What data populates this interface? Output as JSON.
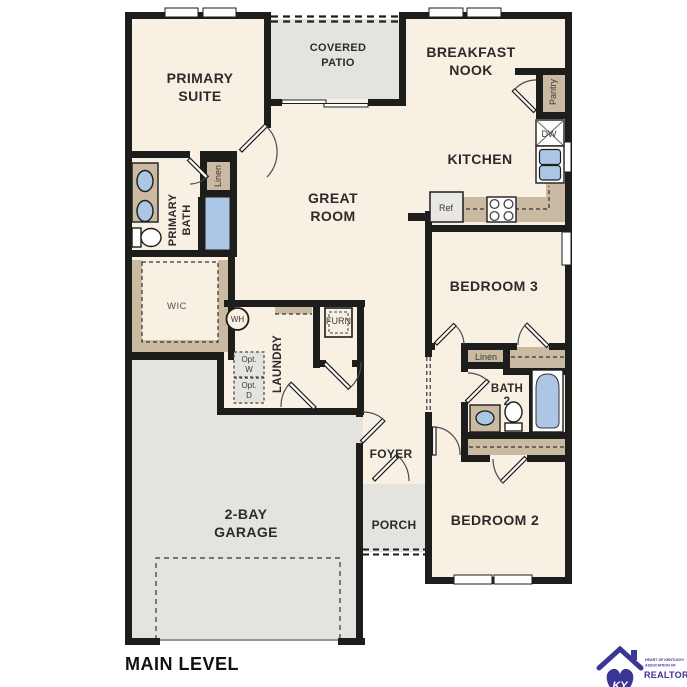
{
  "title": "MAIN LEVEL",
  "labels": {
    "primary_suite": [
      "PRIMARY",
      "SUITE"
    ],
    "covered_patio": [
      "COVERED",
      "PATIO"
    ],
    "breakfast_nook": [
      "BREAKFAST",
      "NOOK"
    ],
    "kitchen": "KITCHEN",
    "great_room": [
      "GREAT",
      "ROOM"
    ],
    "primary_bath": [
      "PRIMARY",
      "BATH"
    ],
    "linen_primary": "Linen",
    "wic": "WIC",
    "pantry": "Pantry",
    "dishwasher": "DW",
    "refrigerator": "Ref",
    "water_heater": "WH",
    "furnace": "FURN",
    "opt_washer": [
      "Opt.",
      "W"
    ],
    "opt_dryer": [
      "Opt.",
      "D"
    ],
    "laundry": "LAUNDRY",
    "bedroom3": "BEDROOM 3",
    "linen_hall": "Linen",
    "bath2": [
      "BATH",
      "2"
    ],
    "bedroom2": "BEDROOM 2",
    "foyer": "FOYER",
    "porch": "PORCH",
    "garage": [
      "2-BAY",
      "GARAGE"
    ]
  },
  "logo": {
    "monogram": "KY",
    "line1": "HEART OF KENTUCKY",
    "line2": "ASSOCIATION OF",
    "line3": "REALTORS®"
  },
  "colors": {
    "wall": "#1d1d1b",
    "floor": "#f8f0e2",
    "cabinetry_tan": "#cabaa2",
    "concrete_gray": "#e4e3e0",
    "fixture_blue": "#abc7e5",
    "logo_purple": "#3b3596"
  }
}
